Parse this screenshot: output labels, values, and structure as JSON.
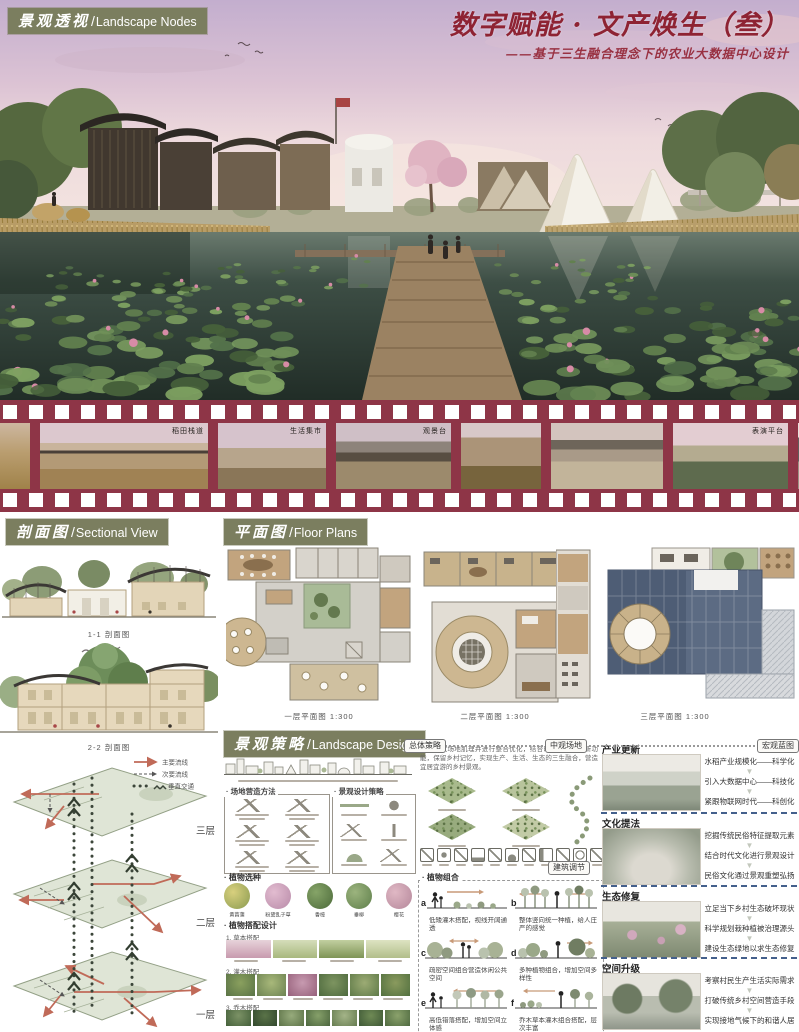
{
  "colors": {
    "olive": "#7b7e5f",
    "maroon": "#8e3547",
    "title_red": "#8e2333",
    "plan_roof_blue": "#5c6b83",
    "arrow_red": "#c06a58"
  },
  "header": {
    "section_zh": "景观透视",
    "section_en": "Landscape Nodes",
    "title": "数字赋能 · 文产焕生（叁）",
    "subtitle": "——基于三生融合理念下的农业大数据中心设计"
  },
  "filmstrip": {
    "frames": [
      {
        "label": ""
      },
      {
        "label": "稻田栈道"
      },
      {
        "label": "生活集市"
      },
      {
        "label": "观景台"
      },
      {
        "label": ""
      },
      {
        "label": ""
      },
      {
        "label": "表演平台"
      },
      {
        "label": ""
      },
      {
        "label": ""
      }
    ]
  },
  "sectional": {
    "zh": "剖面图",
    "en": "Sectional View",
    "cap1": "1-1 剖面图",
    "cap2": "2-2 剖面图"
  },
  "floorplans": {
    "zh": "平面图",
    "en": "Floor Plans",
    "caps": [
      "一层平面图 1:300",
      "二层平面图 1:300",
      "三层平面图 1:300"
    ]
  },
  "axon": {
    "legend": [
      "主要流线",
      "次要流线",
      "垂直交通"
    ],
    "floors": [
      "三层",
      "二层",
      "一层"
    ]
  },
  "strategy": {
    "zh": "景观策略",
    "en": "Landscape Design",
    "tags": [
      "总体策略",
      "中观场地",
      "宏观蓝图"
    ],
    "intro": "梳理现状场地肌理并进行整合优化，结合时代需求植入新功能，保留乡村记忆，实现生产、生活、生态的三生融合，营造宜居宜游的乡村景观。",
    "panelA": "场地营造方法",
    "panelB": "景观设计策略",
    "tag_mid": "建筑调节",
    "plant_select": "植物选种",
    "plant_names": [
      "黄菖蒲",
      "粉黛乱子草",
      "香樟",
      "垂柳",
      "樱花"
    ],
    "plant_design": "植物搭配设计",
    "rows": [
      "1. 草本搭配",
      "2. 灌木搭配",
      "3. 乔木搭配"
    ],
    "combo_title": "植物组合",
    "combos": [
      {
        "letter": "a",
        "cap": "低矮灌木搭配，视线开阔通透"
      },
      {
        "letter": "b",
        "cap": "整体竖向统一种植，给人庄严的感觉"
      },
      {
        "letter": "c",
        "cap": "疏密空间组合营造休闲公共空间"
      },
      {
        "letter": "d",
        "cap": "多种植物组合，增加空间多样性"
      },
      {
        "letter": "e",
        "cap": "高低错落搭配，增加空间立体感"
      },
      {
        "letter": "f",
        "cap": "乔木草本灌木组合搭配，层次丰富"
      }
    ]
  },
  "right": {
    "blocks": [
      {
        "title": "产业更新",
        "lines": [
          "水稻产业规模化——科学化",
          "引入大数据中心——科技化",
          "紧跟物联网时代——科创化"
        ]
      },
      {
        "title": "文化提法",
        "lines": [
          "挖掘传统民俗特征提取元素",
          "结合时代文化进行景观设计",
          "民俗文化通过景观重塑弘扬"
        ]
      },
      {
        "title": "生态修复",
        "lines": [
          "立足当下乡村生态破坏现状",
          "科学规划栽种植被治理源头",
          "建设生态绿地以求生态修复"
        ]
      },
      {
        "title": "空间升级",
        "lines": [
          "考察村民生产生活实际需求",
          "打破传统乡村空间营造手段",
          "实现接地气候下的和谐人居"
        ]
      }
    ]
  }
}
